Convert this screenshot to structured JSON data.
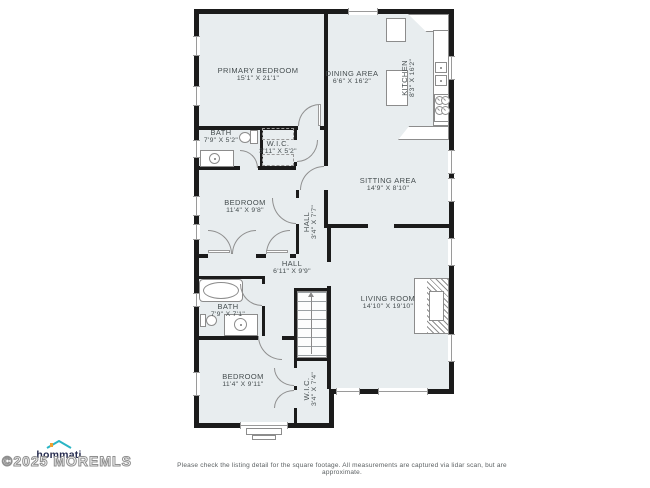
{
  "plan": {
    "title": "residential-floor-plan",
    "rooms": [
      {
        "name": "PRIMARY BEDROOM",
        "dims": "15'1\" X 21'1\""
      },
      {
        "name": "DINING AREA",
        "dims": "6'6\" X 16'2\""
      },
      {
        "name": "KITCHEN",
        "dims": "8'3\" X 16'2\""
      },
      {
        "name": "BATH",
        "dims": "7'9\" X 5'2\""
      },
      {
        "name": "W.I.C.",
        "dims": "3'11\" X 5'2\""
      },
      {
        "name": "BEDROOM",
        "dims": "11'4\" X 9'8\""
      },
      {
        "name": "HALL",
        "dims": "3'4\" X 7'7\""
      },
      {
        "name": "SITTING AREA",
        "dims": "14'9\" X 8'10\""
      },
      {
        "name": "HALL",
        "dims": "6'11\" X 9'9\""
      },
      {
        "name": "LIVING ROOM",
        "dims": "14'10\" X 19'10\""
      },
      {
        "name": "BATH",
        "dims": "7'9\" X 7'1\""
      },
      {
        "name": "BEDROOM",
        "dims": "11'4\" X 9'11\""
      },
      {
        "name": "W.I.C.",
        "dims": "3'4\" X 7'4\""
      }
    ],
    "fixtures": [
      "refrigerator",
      "kitchen-island",
      "double-sink",
      "stove",
      "bathtub",
      "toilet",
      "vanity-sink",
      "staircase",
      "fireplace",
      "closet-rod"
    ]
  },
  "footer": {
    "logo_text": "hommati",
    "watermark": "©2025 MOREMLS",
    "disclaimer": "Please check the listing detail for the square footage. All measurements are captured via lidar scan, but are approximate."
  },
  "colors": {
    "wall": "#1b1b1b",
    "floor": "#e8edef",
    "logo_roof": "#2ab5c4",
    "logo_chimney": "#f0a030",
    "logo_text": "#252b4e",
    "label_text": "#454d4f"
  }
}
